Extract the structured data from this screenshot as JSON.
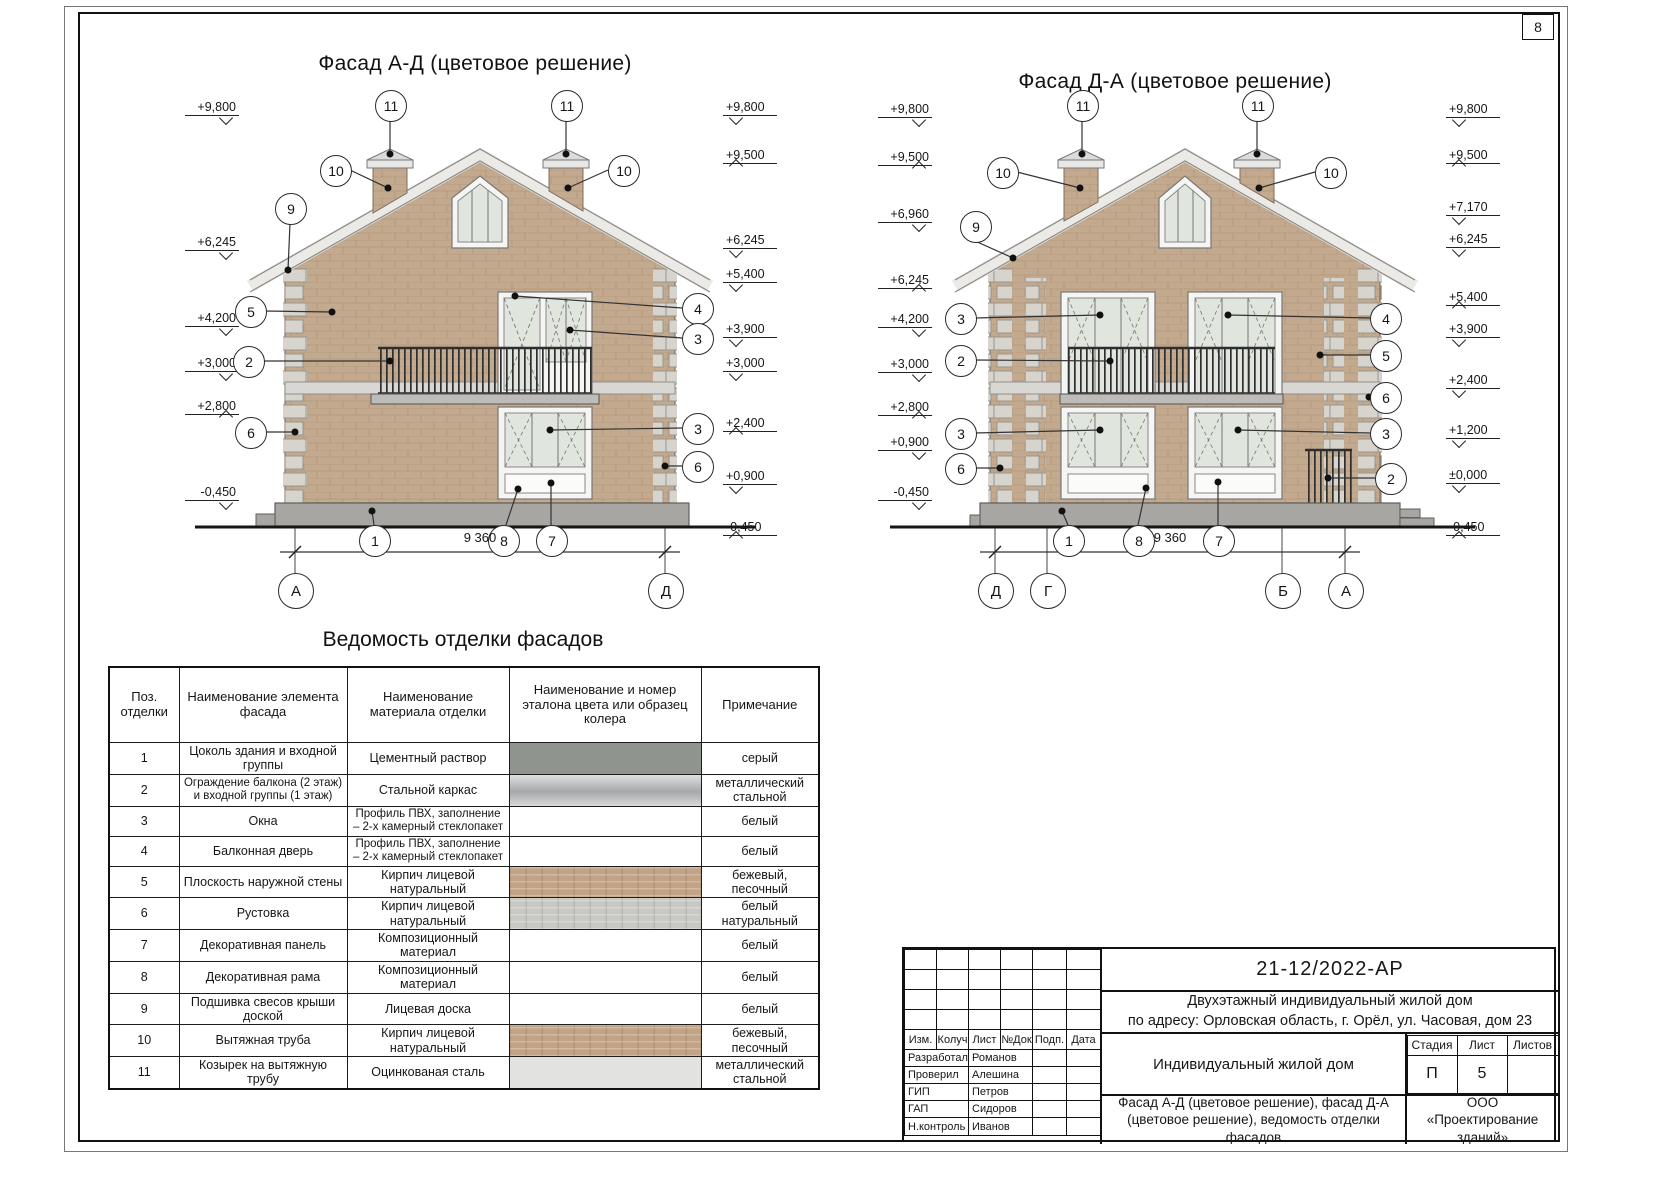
{
  "page": {
    "sheet_number": "8"
  },
  "facade_left": {
    "title": "Фасад А-Д (цветовое решение)",
    "marks_left": [
      "+9,800",
      "+6,245",
      "+4,200",
      "+3,000",
      "+2,800",
      "-0,450"
    ],
    "marks_right": [
      "+9,800",
      "+9,500",
      "+6,245",
      "+5,400",
      "+3,900",
      "+3,000",
      "+2,400",
      "+0,900",
      "-0,450"
    ],
    "callouts": {
      "c11a": "11",
      "c11b": "11",
      "c10a": "10",
      "c10b": "10",
      "c9": "9",
      "c5": "5",
      "c2": "2",
      "c4": "4",
      "c3a": "3",
      "c3b": "3",
      "c6a": "6",
      "c6b": "6",
      "c1": "1",
      "c8": "8",
      "c7": "7"
    },
    "dimension": "9 360",
    "axes": [
      "А",
      "Д"
    ]
  },
  "facade_right": {
    "title": "Фасад Д-А (цветовое решение)",
    "marks_left": [
      "+9,800",
      "+9,500",
      "+6,960",
      "+6,245",
      "+4,200",
      "+3,000",
      "+2,800",
      "+0,900",
      "-0,450"
    ],
    "marks_right": [
      "+9,800",
      "+9,500",
      "+7,170",
      "+6,245",
      "+5,400",
      "+3,900",
      "+2,400",
      "+1,200",
      "±0,000",
      "-0,450"
    ],
    "callouts": {
      "c11a": "11",
      "c11b": "11",
      "c10a": "10",
      "c10b": "10",
      "c9": "9",
      "c3a": "3",
      "c4": "4",
      "c2a": "2",
      "c5": "5",
      "c6a": "6",
      "c3b": "3",
      "c3c": "3",
      "c6b": "6",
      "c2b": "2",
      "c1": "1",
      "c8": "8",
      "c7": "7"
    },
    "dimension": "9 360",
    "axes": [
      "Д",
      "Г",
      "Б",
      "А"
    ]
  },
  "finish_table": {
    "title": "Ведомость отделки фасадов",
    "headers": [
      "Поз. отделки",
      "Наименование элемента фасада",
      "Наименование материала отделки",
      "Наименование и номер эталона цвета или образец колера",
      "Примечание"
    ],
    "rows": [
      {
        "pos": "1",
        "element": "Цоколь здания и входной группы",
        "material": "Цементный раствор",
        "swatch": "#8f948e",
        "note": "серый"
      },
      {
        "pos": "2",
        "element": "Ограждение балкона (2 этаж) и входной группы (1 этаж)",
        "material": "Стальной каркас",
        "swatch": "#b9bcbe",
        "note": "металлический стальной"
      },
      {
        "pos": "3",
        "element": "Окна",
        "material": "Профиль ПВХ, заполнение – 2-х камерный стеклопакет",
        "swatch": "",
        "note": "белый"
      },
      {
        "pos": "4",
        "element": "Балконная дверь",
        "material": "Профиль ПВХ, заполнение – 2-х камерный стеклопакет",
        "swatch": "",
        "note": "белый"
      },
      {
        "pos": "5",
        "element": "Плоскость наружной стены",
        "material": "Кирпич лицевой натуральный",
        "swatch": "#c2a385",
        "note": "бежевый, песочный"
      },
      {
        "pos": "6",
        "element": "Рустовка",
        "material": "Кирпич лицевой натуральный",
        "swatch": "#c8c9c4",
        "note": "белый натуральный"
      },
      {
        "pos": "7",
        "element": "Декоративная панель",
        "material": "Композиционный материал",
        "swatch": "",
        "note": "белый"
      },
      {
        "pos": "8",
        "element": "Декоративная рама",
        "material": "Композиционный материал",
        "swatch": "",
        "note": "белый"
      },
      {
        "pos": "9",
        "element": "Подшивка свесов крыши доской",
        "material": "Лицевая доска",
        "swatch": "",
        "note": "белый"
      },
      {
        "pos": "10",
        "element": "Вытяжная труба",
        "material": "Кирпич лицевой натуральный",
        "swatch": "#c2a385",
        "note": "бежевый, песочный"
      },
      {
        "pos": "11",
        "element": "Козырек на вытяжную трубу",
        "material": "Оцинкованая сталь",
        "swatch": "#e2e2e0",
        "note": "металлический стальной"
      }
    ]
  },
  "titleblock": {
    "doc_number": "21-12/2022-АР",
    "project_line1": "Двухэтажный индивидуальный жилой дом",
    "project_line2": "по адресу: Орловская область, г. Орёл, ул. Часовая, дом 23",
    "object_name": "Индивидуальный жилой дом",
    "sheet_title_line1": "Фасад А-Д (цветовое решение), фасад Д-А",
    "sheet_title_line2": "(цветовое решение), ведомость отделки фасадов",
    "company": "ООО «Проектирование зданий»",
    "stage_label": "Стадия",
    "sheet_label": "Лист",
    "sheets_label": "Листов",
    "stage_value": "П",
    "sheet_value": "5",
    "sheets_value": "",
    "rev_headers": [
      "Изм.",
      "Колуч",
      "Лист",
      "№Док",
      "Подп.",
      "Дата"
    ],
    "roles": [
      {
        "role": "Разработал",
        "name": "Романов"
      },
      {
        "role": "Проверил",
        "name": "Алешина"
      },
      {
        "role": "ГИП",
        "name": "Петров"
      },
      {
        "role": "ГАП",
        "name": "Сидоров"
      },
      {
        "role": "Н.контроль",
        "name": "Иванов"
      }
    ]
  },
  "colors": {
    "brick": "#c3a98e",
    "brick_line": "#b2957a",
    "quoin": "#d7d4ce",
    "plinth": "#a7a6a2",
    "glass": "#e0e6de",
    "roof_band": "#eceae6"
  }
}
